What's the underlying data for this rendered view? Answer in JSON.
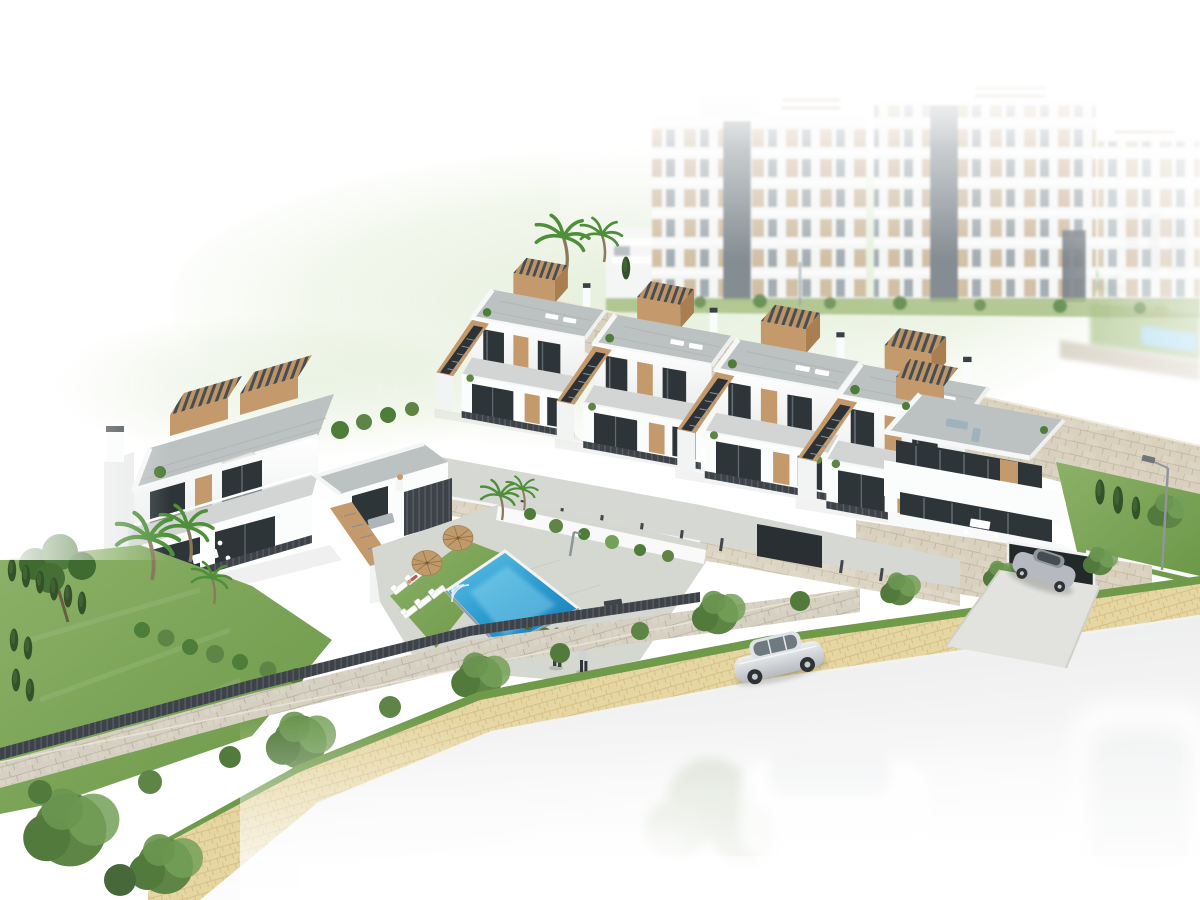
{
  "scene": {
    "title": "Aerial 3D architectural render of a hillside residential development",
    "style": "photorealistic visualization fading to white at the edges",
    "background": {
      "apartment_towers": 3,
      "tower_features": [
        "white facades",
        "tan window panels",
        "gray glazing",
        "dark elevator shafts",
        "rooftop pergola beams"
      ],
      "hill_wash": "pale green lawn fading to white",
      "upper_complex_pool": 1
    },
    "midground": {
      "retaining_wall": "beige stone masonry running diagonally",
      "townhouse_units": 4,
      "townhouse_features": [
        "roof terraces",
        "tan staircase parapets",
        "slatted pergolas",
        "dark glass doors",
        "slatted dividing fences"
      ],
      "corner_villa_features": [
        "curved white balconies",
        "dark glazing bands",
        "stone base",
        "garage opening",
        "silver sports car on driveway"
      ]
    },
    "foreground": {
      "duplex_features": [
        "roof solarium",
        "two pergolas",
        "patio umbrella",
        "sun loungers",
        "outdoor dining table"
      ],
      "pool": {
        "shape": "rotated rectangle",
        "loungers": 6,
        "parasols": 2,
        "sunbather": 1,
        "corner_steps": true
      },
      "people_walking": 2,
      "garden": [
        "lawn",
        "pine tree",
        "palm trees",
        "cypress hedge",
        "olive trees"
      ],
      "boundary": [
        "stone wall",
        "dark slatted fence",
        "shrub row"
      ],
      "street": {
        "sidewalk": "sand colored pavers with grass verges",
        "road": "light asphalt fading to white",
        "parked_sedan": 1,
        "ghost_cars": 3,
        "street_lamp": 1
      }
    }
  },
  "colors": {
    "white": "#ffffff",
    "facade_white": "#fbfcfc",
    "facade_shade": "#eceeed",
    "gable_shade": "#e9ebea",
    "roof_pavement": "#bcc1c2",
    "terrace_floor": "#d2d5d3",
    "deck": "#d5d7d1",
    "wood_accent": "#c49a6c",
    "wood_dark": "#a97f52",
    "window_glass": "#2e3539",
    "glass_reflection": "#7d8a92",
    "fence_dark": "#3d4349",
    "stone_upper": "#d9d1be",
    "stone_lower": "#d6d0c3",
    "stone_joint": "#c3b9a2",
    "pool_light": "#62c4e8",
    "pool_deep": "#1a7db5",
    "pool_ripple": "#8fd9f0",
    "grass_bright": "#7fa75b",
    "grass_dark": "#5d8a3e",
    "foliage": "#4e7d3a",
    "foliage_olive": "#5e8446",
    "foliage_light": "#74a058",
    "cypress": "#33522a",
    "path_sand": "#e6d6a2",
    "path_joint": "#d1ba84",
    "road": "#e8e9e9",
    "car_silver": "#ccd1d5",
    "car_dark": "#2e3235",
    "metal": "#98a0a5",
    "hill": "#dfead0",
    "apartment_tan": "#c9b293",
    "apartment_glass": "#95a0a8",
    "shaft_gray": "#7c858c",
    "skin": "#c8996f",
    "accent_red": "#c4554e",
    "sofa_gray": "#9fb3bd"
  }
}
